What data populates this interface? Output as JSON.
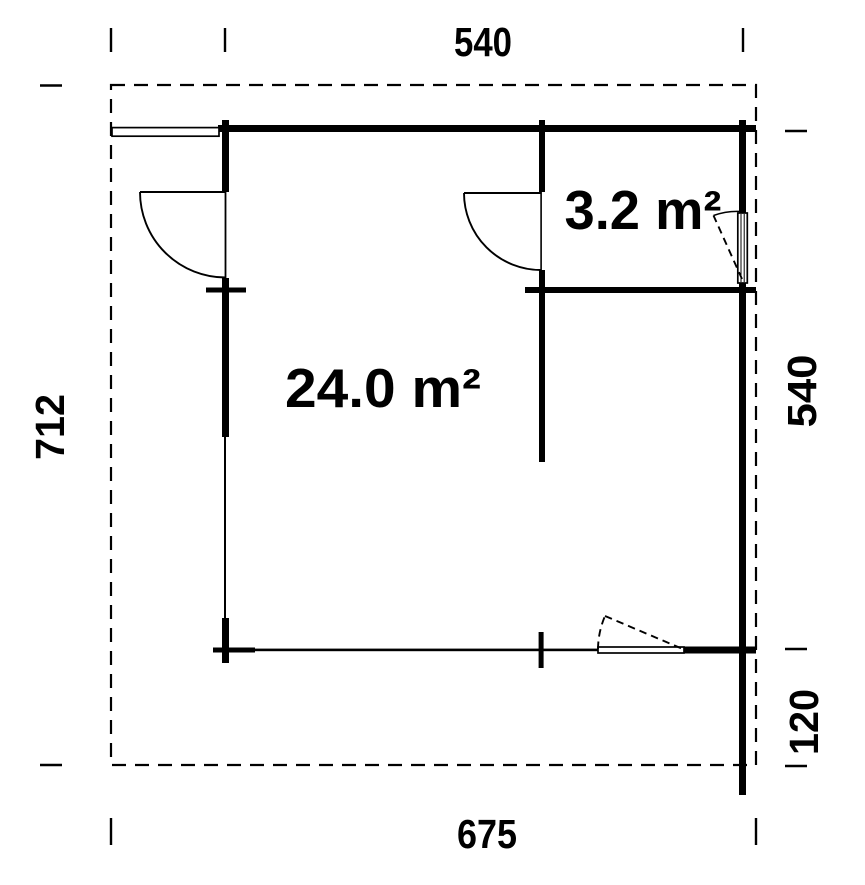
{
  "plan": {
    "background_color": "#ffffff",
    "line_color": "#000000",
    "rooms": [
      {
        "name": "main-room",
        "area_label": "24.0 m²"
      },
      {
        "name": "side-room",
        "area_label": "3.2 m²"
      }
    ],
    "dimensions": {
      "top_width": "540",
      "left_height": "712",
      "right_upper_height": "540",
      "right_lower_height": "120",
      "bottom_width": "675"
    }
  }
}
